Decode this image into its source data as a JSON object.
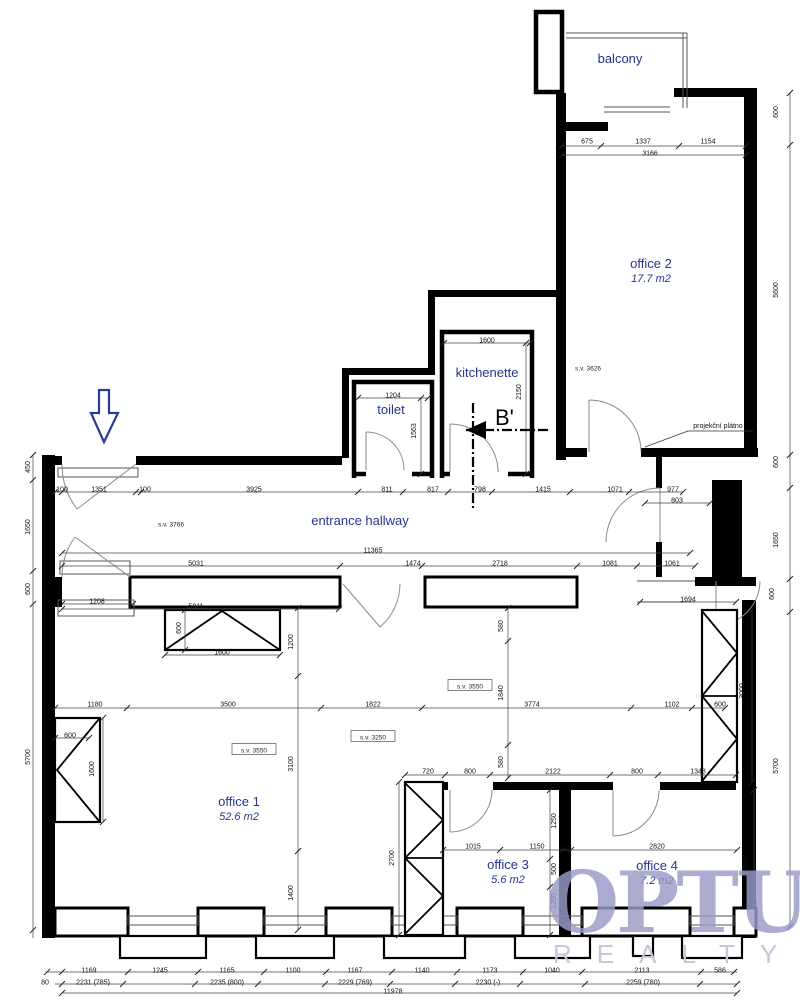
{
  "accent_color": "#27348f",
  "watermark": {
    "brand": "OPTUS",
    "subbrand": "REALTY",
    "brand_color": "#9a9bc8",
    "sub_color": "#c6c6d8"
  },
  "annotations": {
    "section_label": "B'",
    "projection_screen": "projekční plátno"
  },
  "rooms": [
    {
      "id": "balcony",
      "name": "balcony",
      "area": "",
      "x": 620,
      "y": 63
    },
    {
      "id": "office-2",
      "name": "office 2",
      "area": "17.7 m2",
      "x": 651,
      "y": 268
    },
    {
      "id": "kitchenette",
      "name": "kitchenette",
      "area": "",
      "x": 487,
      "y": 377
    },
    {
      "id": "toilet",
      "name": "toilet",
      "area": "",
      "x": 391,
      "y": 414
    },
    {
      "id": "entrance-hallway",
      "name": "entrance hallway",
      "area": "",
      "x": 360,
      "y": 525
    },
    {
      "id": "office-1",
      "name": "office 1",
      "area": "52.6 m2",
      "x": 239,
      "y": 806
    },
    {
      "id": "office-3",
      "name": "office 3",
      "area": "5.6 m2",
      "x": 508,
      "y": 869
    },
    {
      "id": "office-4",
      "name": "office 4",
      "area": "7.2 m2",
      "x": 657,
      "y": 870
    }
  ],
  "ceiling_labels": [
    {
      "text": "s.v. 3766",
      "x": 171,
      "y": 524,
      "boxed": false
    },
    {
      "text": "s.v. 3626",
      "x": 588,
      "y": 368,
      "boxed": false
    },
    {
      "text": "s.v. 3550",
      "x": 470,
      "y": 686,
      "boxed": true
    },
    {
      "text": "s.v. 3250",
      "x": 373,
      "y": 737,
      "boxed": true
    },
    {
      "text": "s.v. 3550",
      "x": 254,
      "y": 750,
      "boxed": true
    }
  ],
  "dims_h": [
    {
      "t": "675",
      "x": 587,
      "y": 141
    },
    {
      "t": "1337",
      "x": 643,
      "y": 141
    },
    {
      "t": "1154",
      "x": 708,
      "y": 141
    },
    {
      "t": "3166",
      "x": 650,
      "y": 153
    },
    {
      "t": "1600",
      "x": 487,
      "y": 340
    },
    {
      "t": "1204",
      "x": 393,
      "y": 395
    },
    {
      "t": "100",
      "x": 62,
      "y": 489
    },
    {
      "t": "1351",
      "x": 99,
      "y": 489
    },
    {
      "t": "100",
      "x": 145,
      "y": 489
    },
    {
      "t": "3925",
      "x": 254,
      "y": 489
    },
    {
      "t": "811",
      "x": 387,
      "y": 489
    },
    {
      "t": "817",
      "x": 433,
      "y": 489
    },
    {
      "t": "798",
      "x": 480,
      "y": 489
    },
    {
      "t": "1415",
      "x": 543,
      "y": 489
    },
    {
      "t": "1071",
      "x": 615,
      "y": 489
    },
    {
      "t": "977",
      "x": 673,
      "y": 489
    },
    {
      "t": "803",
      "x": 677,
      "y": 500
    },
    {
      "t": "11365",
      "x": 373,
      "y": 550
    },
    {
      "t": "5031",
      "x": 196,
      "y": 563
    },
    {
      "t": "1474",
      "x": 413,
      "y": 563
    },
    {
      "t": "2718",
      "x": 500,
      "y": 563
    },
    {
      "t": "1081",
      "x": 610,
      "y": 563
    },
    {
      "t": "1061",
      "x": 672,
      "y": 563
    },
    {
      "t": "1208",
      "x": 97,
      "y": 601
    },
    {
      "t": "5011",
      "x": 196,
      "y": 606
    },
    {
      "t": "1694",
      "x": 688,
      "y": 599
    },
    {
      "t": "1180",
      "x": 95,
      "y": 704
    },
    {
      "t": "3500",
      "x": 228,
      "y": 704
    },
    {
      "t": "1822",
      "x": 373,
      "y": 704
    },
    {
      "t": "3774",
      "x": 532,
      "y": 704
    },
    {
      "t": "1102",
      "x": 672,
      "y": 704
    },
    {
      "t": "600",
      "x": 720,
      "y": 704
    },
    {
      "t": "1600",
      "x": 222,
      "y": 652
    },
    {
      "t": "600",
      "x": 70,
      "y": 735
    },
    {
      "t": "720",
      "x": 428,
      "y": 771
    },
    {
      "t": "800",
      "x": 470,
      "y": 771
    },
    {
      "t": "2122",
      "x": 553,
      "y": 771
    },
    {
      "t": "800",
      "x": 637,
      "y": 771
    },
    {
      "t": "1348",
      "x": 698,
      "y": 771
    },
    {
      "t": "1015",
      "x": 473,
      "y": 846
    },
    {
      "t": "1150",
      "x": 537,
      "y": 846
    },
    {
      "t": "2820",
      "x": 657,
      "y": 846
    },
    {
      "t": "1169",
      "x": 89,
      "y": 970
    },
    {
      "t": "1245",
      "x": 160,
      "y": 970
    },
    {
      "t": "1165",
      "x": 227,
      "y": 970
    },
    {
      "t": "1100",
      "x": 293,
      "y": 970
    },
    {
      "t": "1167",
      "x": 355,
      "y": 970
    },
    {
      "t": "1140",
      "x": 422,
      "y": 970
    },
    {
      "t": "1173",
      "x": 490,
      "y": 970
    },
    {
      "t": "1040",
      "x": 552,
      "y": 970
    },
    {
      "t": "2113",
      "x": 642,
      "y": 970
    },
    {
      "t": "586",
      "x": 720,
      "y": 970
    },
    {
      "t": "2231 (785)",
      "x": 93,
      "y": 982
    },
    {
      "t": "2235 (800)",
      "x": 227,
      "y": 982
    },
    {
      "t": "2229 (769)",
      "x": 355,
      "y": 982
    },
    {
      "t": "2230 (-)",
      "x": 488,
      "y": 982
    },
    {
      "t": "2259 (780)",
      "x": 643,
      "y": 982
    },
    {
      "t": "11978",
      "x": 393,
      "y": 991
    },
    {
      "t": "80",
      "x": 45,
      "y": 982
    }
  ],
  "dims_v": [
    {
      "t": "450",
      "x": 30,
      "y": 467
    },
    {
      "t": "1650",
      "x": 30,
      "y": 527
    },
    {
      "t": "600",
      "x": 30,
      "y": 589
    },
    {
      "t": "5700",
      "x": 30,
      "y": 757
    },
    {
      "t": "600",
      "x": 778,
      "y": 112
    },
    {
      "t": "5600",
      "x": 778,
      "y": 290
    },
    {
      "t": "600",
      "x": 778,
      "y": 462
    },
    {
      "t": "1650",
      "x": 778,
      "y": 540
    },
    {
      "t": "600",
      "x": 774,
      "y": 594
    },
    {
      "t": "5700",
      "x": 778,
      "y": 766
    },
    {
      "t": "1563",
      "x": 416,
      "y": 431
    },
    {
      "t": "2150",
      "x": 521,
      "y": 392
    },
    {
      "t": "1200",
      "x": 293,
      "y": 642
    },
    {
      "t": "3100",
      "x": 293,
      "y": 764
    },
    {
      "t": "1400",
      "x": 293,
      "y": 893
    },
    {
      "t": "600",
      "x": 181,
      "y": 628
    },
    {
      "t": "1600",
      "x": 94,
      "y": 769
    },
    {
      "t": "580",
      "x": 503,
      "y": 626
    },
    {
      "t": "1840",
      "x": 503,
      "y": 693
    },
    {
      "t": "580",
      "x": 503,
      "y": 762
    },
    {
      "t": "1250",
      "x": 556,
      "y": 821
    },
    {
      "t": "500",
      "x": 556,
      "y": 869
    },
    {
      "t": "1250",
      "x": 556,
      "y": 901
    },
    {
      "t": "2700",
      "x": 394,
      "y": 858
    },
    {
      "t": "3000",
      "x": 744,
      "y": 691
    },
    {
      "t": "2060",
      "x": 748,
      "y": 862
    }
  ]
}
